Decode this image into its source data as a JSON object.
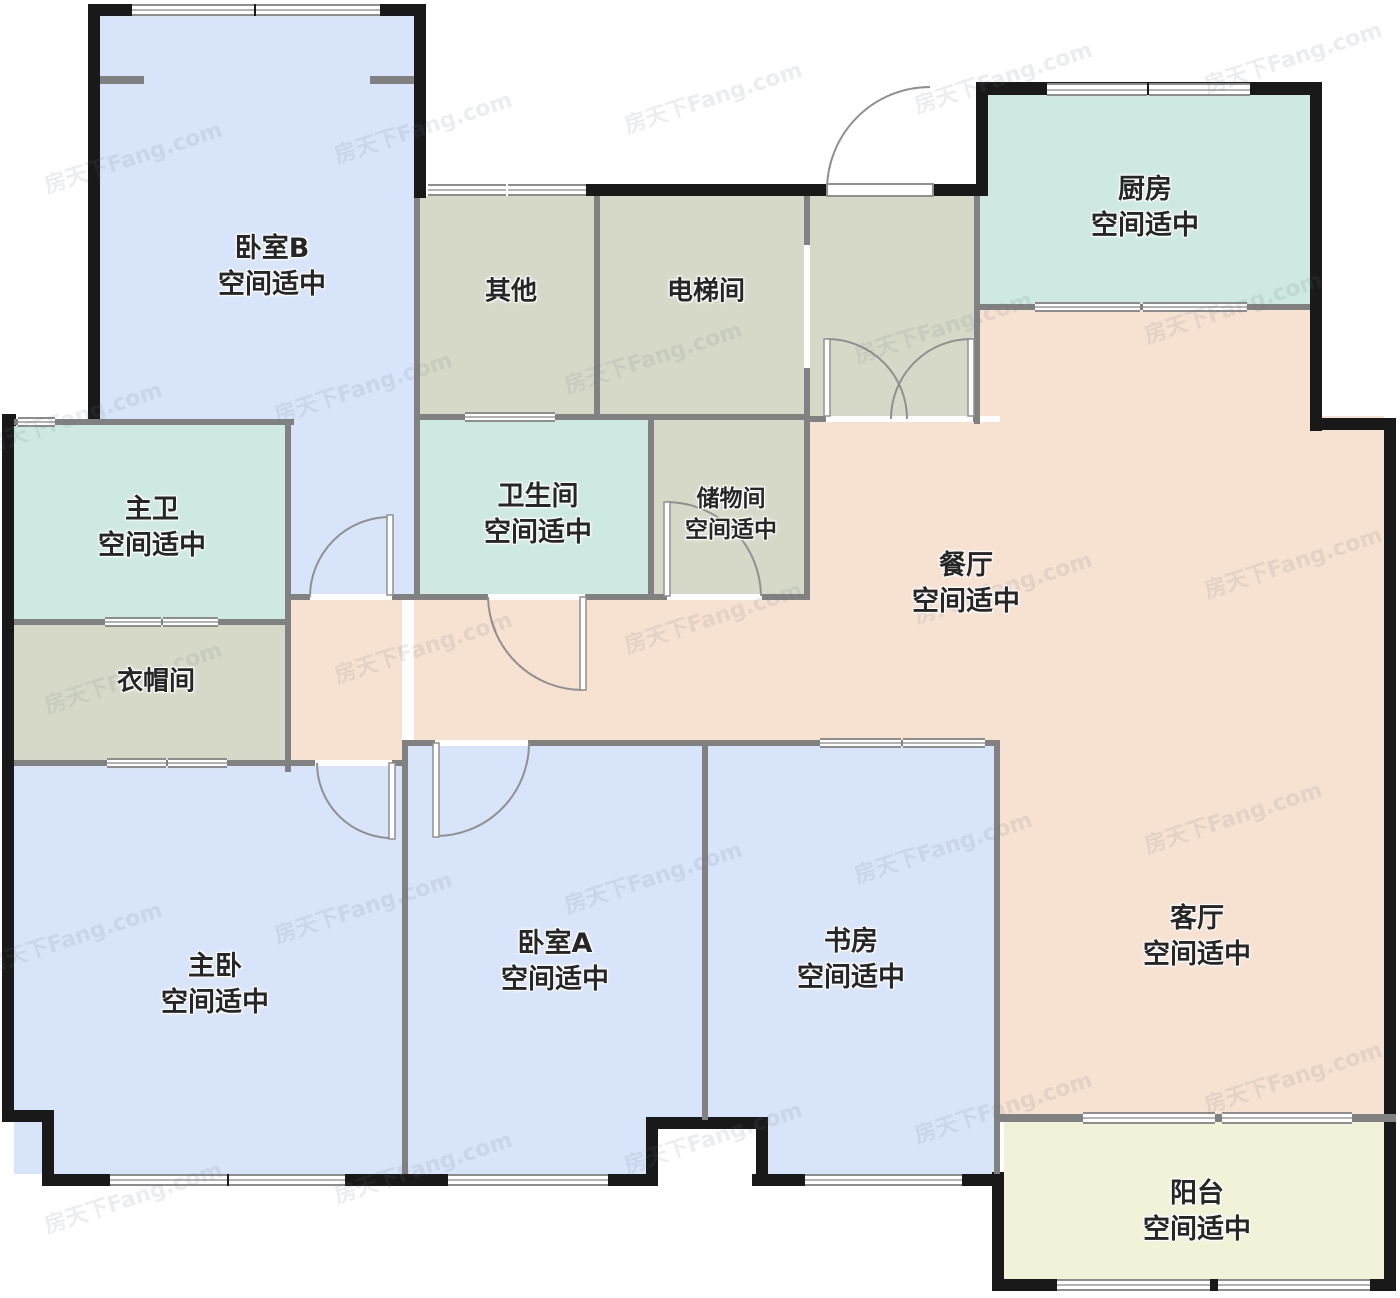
{
  "watermark": "房天下Fang.com",
  "rooms": [
    {
      "id": "bedroom-b",
      "name": "卧室B",
      "status": "空间适中"
    },
    {
      "id": "other",
      "name": "其他",
      "status": ""
    },
    {
      "id": "elevator",
      "name": "电梯间",
      "status": ""
    },
    {
      "id": "kitchen",
      "name": "厨房",
      "status": "空间适中"
    },
    {
      "id": "master-bath",
      "name": "主卫",
      "status": "空间适中"
    },
    {
      "id": "bathroom",
      "name": "卫生间",
      "status": "空间适中"
    },
    {
      "id": "storage",
      "name": "储物间",
      "status": "空间适中"
    },
    {
      "id": "dining",
      "name": "餐厅",
      "status": "空间适中"
    },
    {
      "id": "cloakroom",
      "name": "衣帽间",
      "status": ""
    },
    {
      "id": "master-bed",
      "name": "主卧",
      "status": "空间适中"
    },
    {
      "id": "bedroom-a",
      "name": "卧室A",
      "status": "空间适中"
    },
    {
      "id": "study",
      "name": "书房",
      "status": "空间适中"
    },
    {
      "id": "living",
      "name": "客厅",
      "status": "空间适中"
    },
    {
      "id": "balcony",
      "name": "阳台",
      "status": "空间适中"
    }
  ],
  "colors": {
    "bedroom_fill": "#d8e4f9",
    "utility_fill": "#d6d9c8",
    "bath_kitchen_fill": "#cde9e2",
    "dining_living_fill": "#f7e1d1",
    "balcony_fill": "#f1f2d8",
    "exterior_wall": "#191919",
    "interior_wall": "#818181",
    "label_text": "#262626"
  }
}
